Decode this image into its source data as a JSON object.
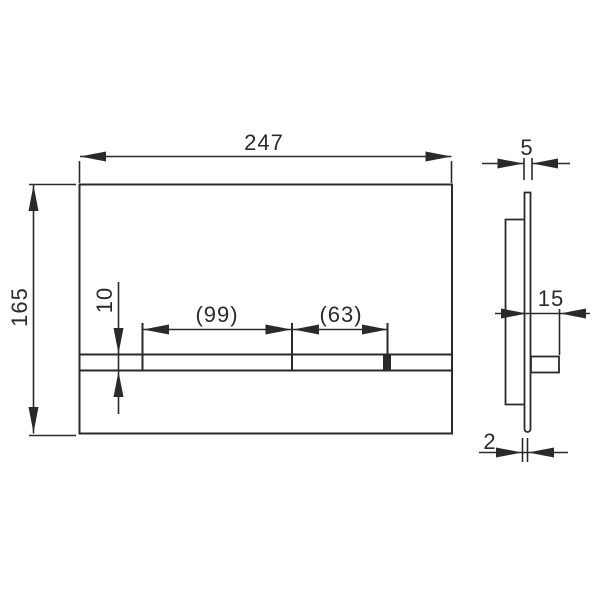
{
  "drawing": {
    "title": "flush-plate-technical-drawing",
    "front_view": {
      "overall_width_mm": "247",
      "overall_height_mm": "165",
      "button_strip_height_mm": "10",
      "large_button_width_mm": "(99)",
      "small_button_width_mm": "(63)"
    },
    "side_view": {
      "plate_thickness_mm": "5",
      "button_projection_mm": "15",
      "bottom_gap_mm": "2"
    }
  },
  "colors": {
    "line": "#2a2a2a",
    "background": "#ffffff"
  }
}
